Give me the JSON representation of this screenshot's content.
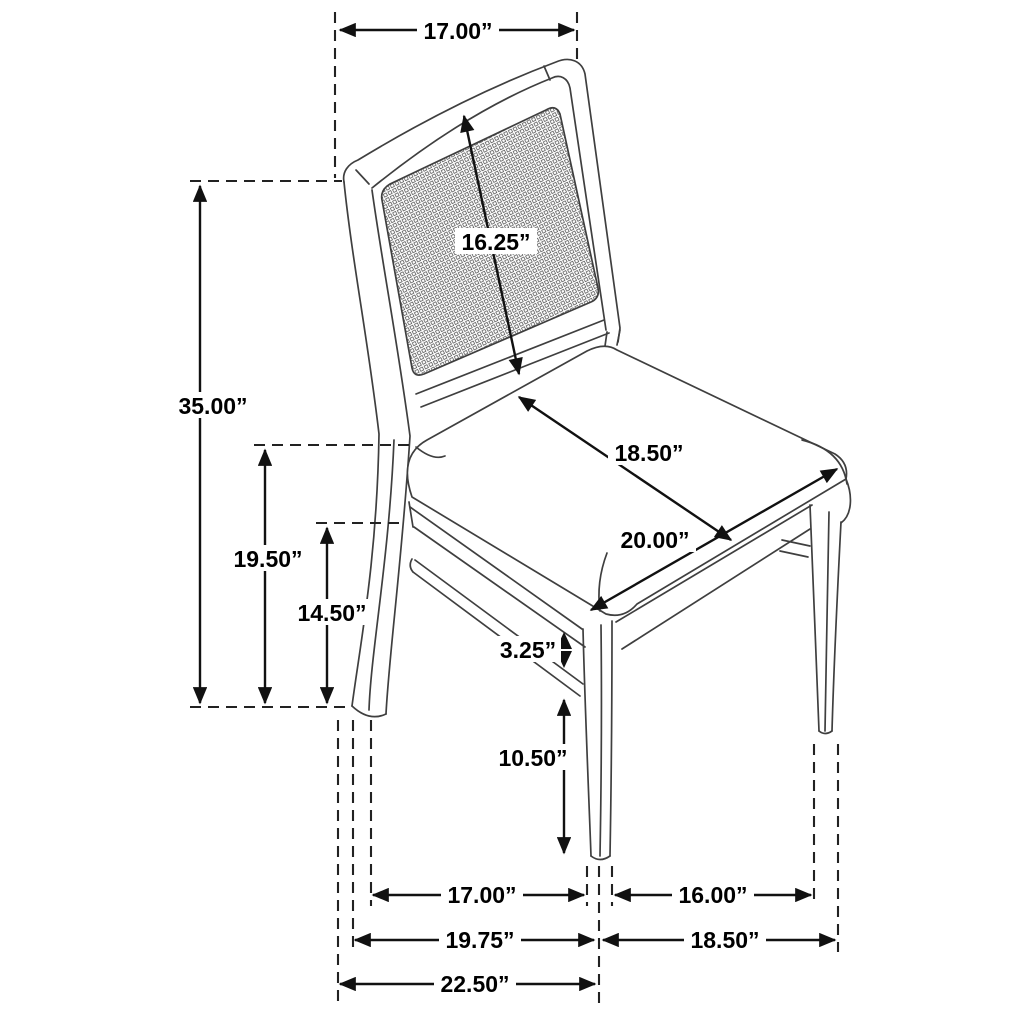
{
  "page": {
    "background": "#ffffff"
  },
  "style": {
    "line_color": "#3f3f3f",
    "dimension_color": "#111111",
    "label_color": "#000000",
    "label_background": "#ffffff"
  },
  "diagram": {
    "subject": "cane-back dining side chair dimension drawing",
    "unit": "inches"
  },
  "dimensions": {
    "top_width": {
      "label": "17.00”",
      "value": 17.0,
      "name": "backrest top width"
    },
    "back_panel": {
      "label": "16.25”",
      "value": 16.25,
      "name": "backrest panel height"
    },
    "overall_height": {
      "label": "35.00”",
      "value": 35.0,
      "name": "overall height"
    },
    "seat_height": {
      "label": "19.50”",
      "value": 19.5,
      "name": "floor to seat top"
    },
    "apron_height": {
      "label": "14.50”",
      "value": 14.5,
      "name": "floor to seat apron"
    },
    "seat_depth": {
      "label": "18.50”",
      "value": 18.5,
      "name": "seat depth"
    },
    "seat_width": {
      "label": "20.00”",
      "value": 20.0,
      "name": "seat width"
    },
    "apron_gap": {
      "label": "3.25”",
      "value": 3.25,
      "name": "apron to stretcher gap"
    },
    "leg_clearance": {
      "label": "10.50”",
      "value": 10.5,
      "name": "stretcher to floor"
    },
    "base_side": {
      "label": "17.00”",
      "value": 17.0,
      "name": "back leg to front leg spacing"
    },
    "base_front": {
      "label": "16.00”",
      "value": 16.0,
      "name": "front leg spacing"
    },
    "base_depth_mid": {
      "label": "19.75”",
      "value": 19.75,
      "name": "base depth at leg centers"
    },
    "base_width_out": {
      "label": "18.50”",
      "value": 18.5,
      "name": "base width outer"
    },
    "base_depth": {
      "label": "22.50”",
      "value": 22.5,
      "name": "overall base depth"
    }
  }
}
